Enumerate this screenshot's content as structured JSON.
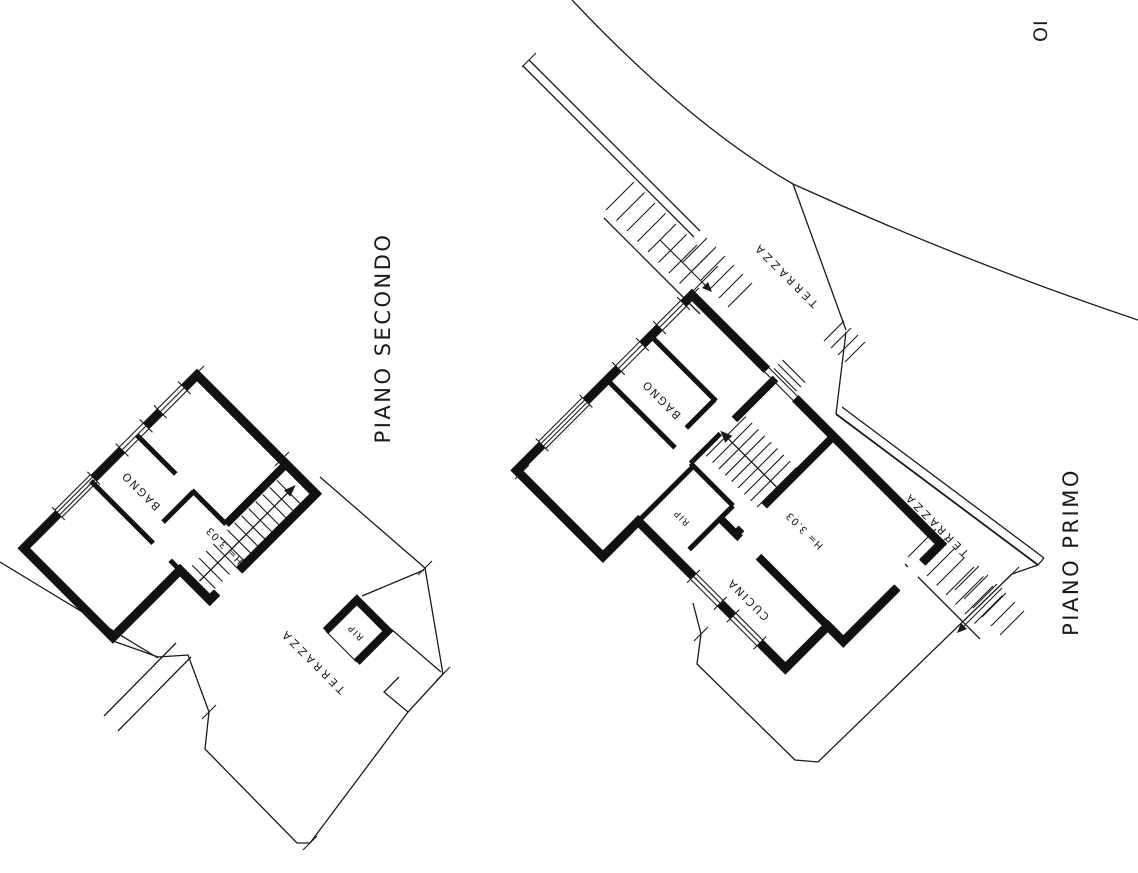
{
  "canvas": {
    "paper_color": "#ffffff",
    "ink_color": "#1a1a1a",
    "description": "Hand-drawn architectural floor plan sheet with two plans rotated ~45 degrees, site boundary curve, terraces and external stairs"
  },
  "drawing": {
    "corner_label": "OI",
    "plans": [
      {
        "id": "second-floor",
        "title": "PIANO SECONDO",
        "rooms": {
          "bathroom": "BAGNO",
          "storage": "RIP",
          "terrace": "TERRAZZA"
        },
        "height_note": "H= 3.03"
      },
      {
        "id": "first-floor",
        "title": "PIANO PRIMO",
        "rooms": {
          "bathroom": "BAGNO",
          "storage": "RIP",
          "kitchen": "CUCINA",
          "terrace_top": "TERRAZZA",
          "terrace_right": "TERRAZZA"
        },
        "height_note": "H= 3.03"
      }
    ]
  }
}
